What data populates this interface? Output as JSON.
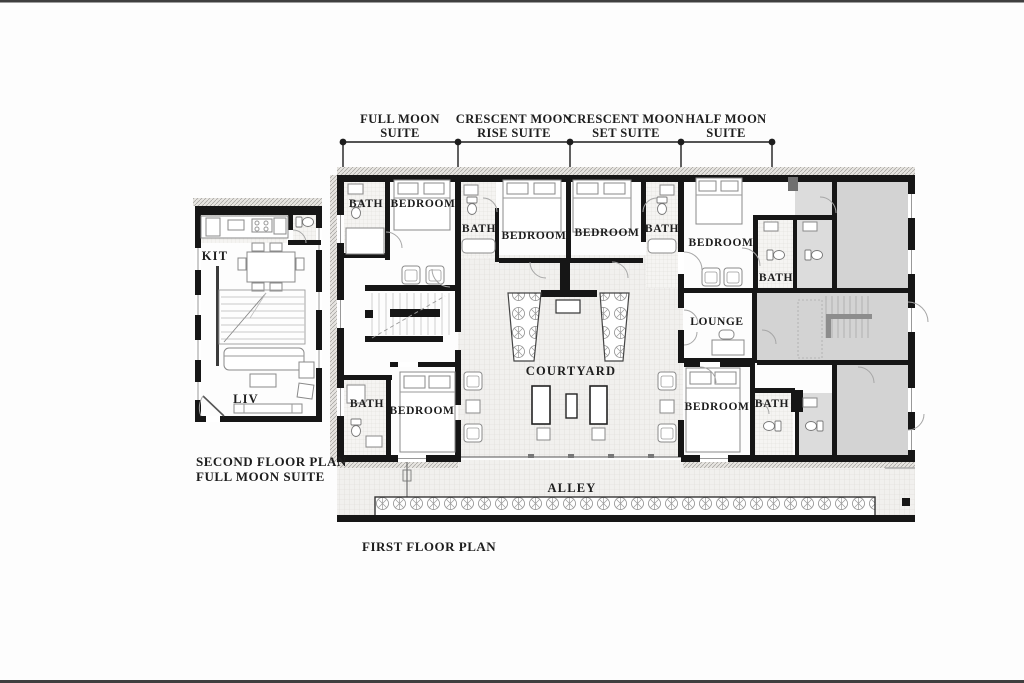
{
  "document": {
    "kind": "architectural floor plan drawing",
    "palette": {
      "background": "#fdfdfd",
      "edge_line": "#3f3f3f",
      "wall": "#161616",
      "gray_room": "#d3d3d3",
      "gray_room_light": "#dcdcdc",
      "stair_bar_gray": "#8d8d8d",
      "tile_bg": "#f1f0ee",
      "tile_line": "#dcdad6",
      "hatch_bg": "#e8e6e2",
      "hatch_line": "#a09e9a",
      "text": "#1d1d1d"
    }
  },
  "dimension_labels": [
    {
      "id": "full-moon-suite",
      "line1": "FULL MOON",
      "line2": "SUITE"
    },
    {
      "id": "crescent-moon-rise-suite",
      "line1": "CRESCENT MOON",
      "line2": "RISE SUITE"
    },
    {
      "id": "crescent-moon-set-suite",
      "line1": "CRESCENT MOON",
      "line2": "SET SUITE"
    },
    {
      "id": "half-moon-suite",
      "line1": "HALF MOON",
      "line2": "SUITE"
    }
  ],
  "second_floor_plan": {
    "caption_line1": "SECOND FLOOR PLAN",
    "caption_line2": "FULL MOON SUITE",
    "room_labels": [
      {
        "id": "kitchen",
        "label": "KIT"
      },
      {
        "id": "living",
        "label": "LIV"
      }
    ]
  },
  "first_floor_plan": {
    "caption": "FIRST FLOOR PLAN",
    "room_labels": [
      {
        "id": "bath-1",
        "label": "BATH"
      },
      {
        "id": "bedroom-1",
        "label": "BEDROOM"
      },
      {
        "id": "bath-2",
        "label": "BATH"
      },
      {
        "id": "bedroom-2",
        "label": "BEDROOM"
      },
      {
        "id": "bedroom-3",
        "label": "BEDROOM"
      },
      {
        "id": "bath-3",
        "label": "BATH"
      },
      {
        "id": "bedroom-4",
        "label": "BEDROOM"
      },
      {
        "id": "bath-4",
        "label": "BATH"
      },
      {
        "id": "lounge",
        "label": "LOUNGE"
      },
      {
        "id": "courtyard",
        "label": "COURTYARD"
      },
      {
        "id": "bath-5",
        "label": "BATH"
      },
      {
        "id": "bedroom-5",
        "label": "BEDROOM"
      },
      {
        "id": "bedroom-6",
        "label": "BEDROOM"
      },
      {
        "id": "bath-6",
        "label": "BATH"
      },
      {
        "id": "alley",
        "label": "ALLEY"
      }
    ]
  }
}
